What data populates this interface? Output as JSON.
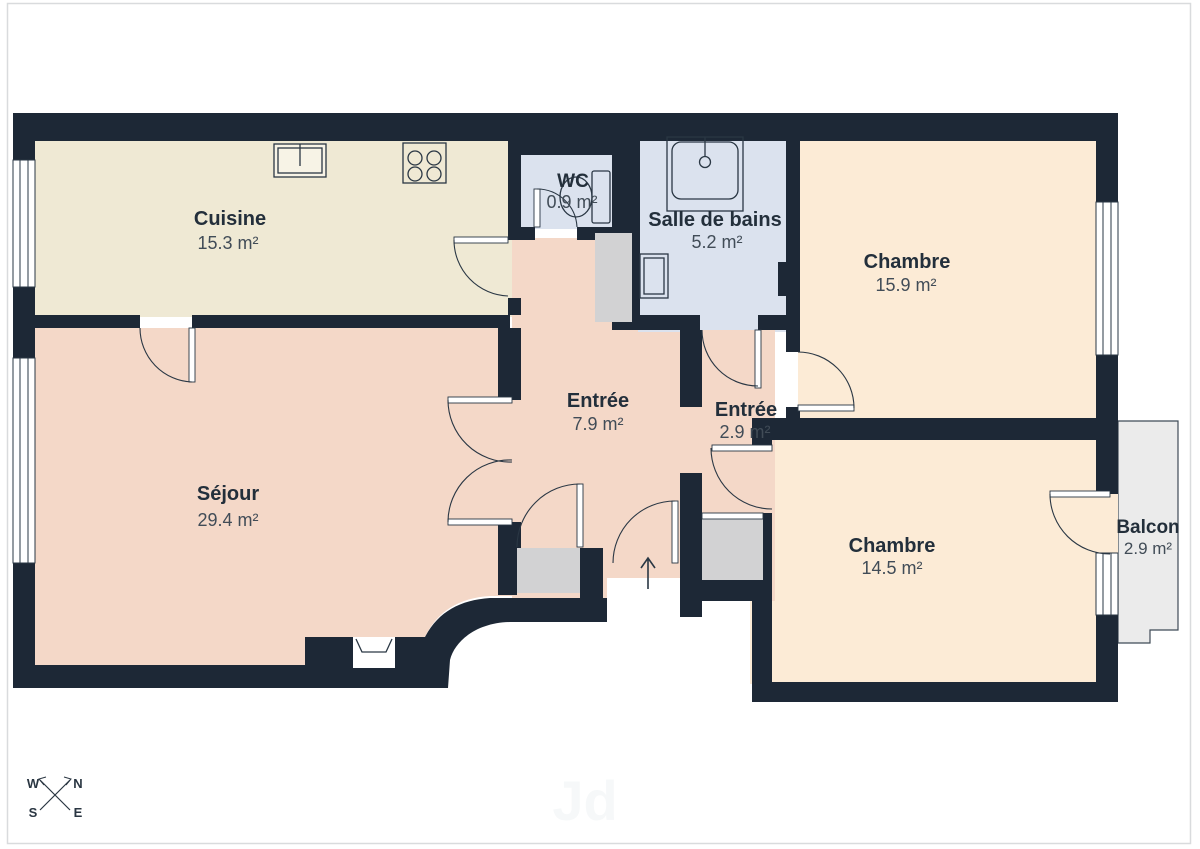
{
  "page": {
    "type": "floor-plan",
    "watermark": "Jd",
    "background": "#ffffff",
    "border_color": "#d9dbdd"
  },
  "palette": {
    "wall": "#1d2836",
    "cuisine": "#efe9d4",
    "entree": "#f4d8c8",
    "chambre": "#fcebd6",
    "bain": "#dbe2ee",
    "closet": "#d2d2d3",
    "balcon": "#ebebeb",
    "line": "#2a3744",
    "fixture_white": "#ffffff"
  },
  "rooms": [
    {
      "id": "cuisine",
      "name": "Cuisine",
      "area": "15.3 m²"
    },
    {
      "id": "wc",
      "name": "WC",
      "area": "0.9 m²"
    },
    {
      "id": "salle-de-bains",
      "name": "Salle de bains",
      "area": "5.2 m²"
    },
    {
      "id": "chambre-1",
      "name": "Chambre",
      "area": "15.9 m²"
    },
    {
      "id": "entree-1",
      "name": "Entrée",
      "area": "7.9 m²"
    },
    {
      "id": "entree-2",
      "name": "Entrée",
      "area": "2.9 m²"
    },
    {
      "id": "sejour",
      "name": "Séjour",
      "area": "29.4 m²"
    },
    {
      "id": "chambre-2",
      "name": "Chambre",
      "area": "14.5 m²"
    },
    {
      "id": "balcon",
      "name": "Balcon",
      "area": "2.9 m²"
    }
  ],
  "compass": {
    "nw": "W",
    "ne": "N",
    "sw": "S",
    "se": "E"
  },
  "icons": {
    "kitchen-sink-icon": "kitchen sink",
    "stove-icon": "4-burner stove",
    "bathtub-icon": "bathtub",
    "washbasin-icon": "washbasin",
    "toilet-icon": "toilet",
    "sejour-sink-icon": "small sink in wall niche",
    "door-arc": "door swing arc",
    "window": "window",
    "entrance-arrow-icon": "entrance direction arrow",
    "compass-rose-icon": "compass rose"
  }
}
